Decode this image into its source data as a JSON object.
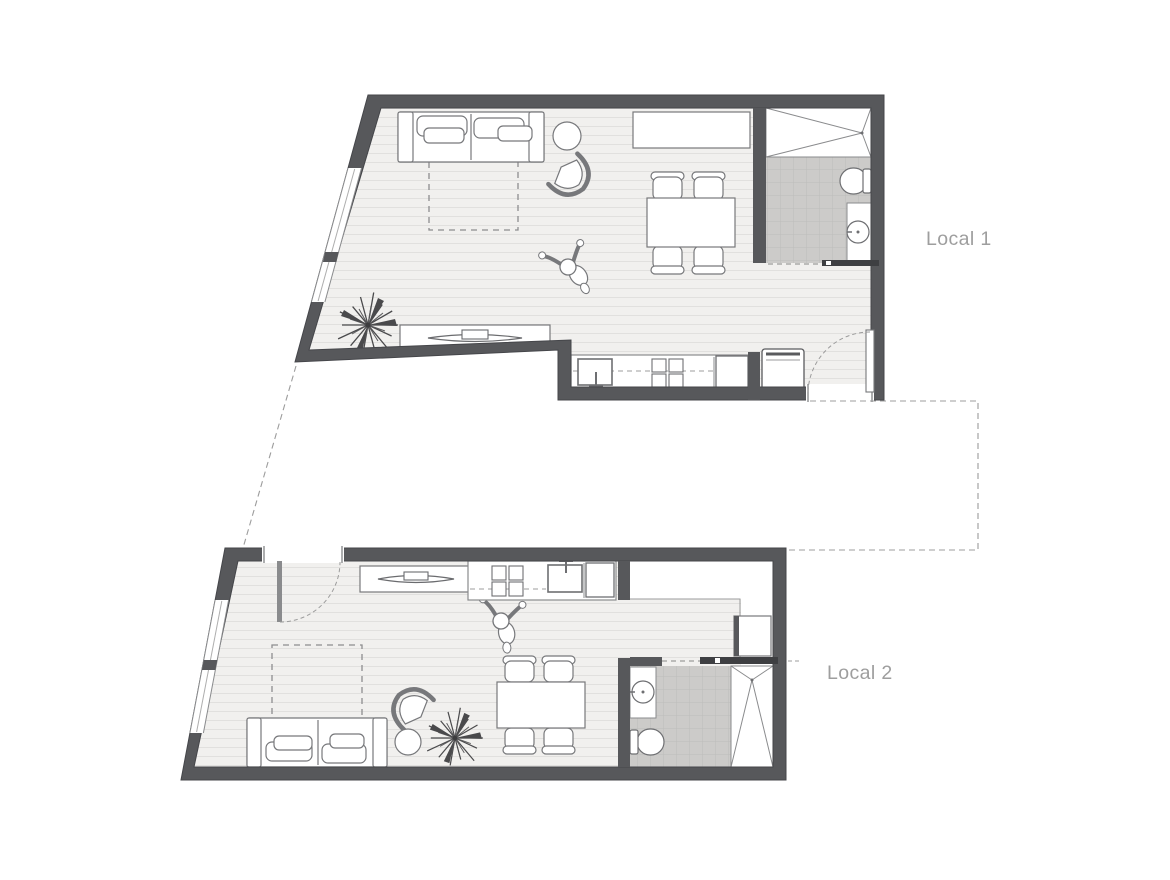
{
  "page": {
    "background_color": "#ffffff",
    "type": "architectural floor plan, two studio units"
  },
  "units": [
    {
      "id": "local-1",
      "label": "Local 1",
      "rooms": [
        "living-dining",
        "kitchen",
        "bathroom",
        "entry"
      ],
      "furniture_icons": [
        "sofa-icon",
        "side-table-icon",
        "lounge-chair-icon",
        "rug-icon",
        "dining-table-icon",
        "dining-chair-icon",
        "sideboard-icon",
        "tv-console-icon",
        "plant-icon",
        "kitchen-counter-icon",
        "kitchen-sink-icon",
        "cooktop-icon",
        "appliance-icon",
        "fridge-icon",
        "shower-icon",
        "toilet-icon",
        "washbasin-icon",
        "person-icon",
        "entry-door-icon",
        "sliding-door-icon",
        "window-icon"
      ]
    },
    {
      "id": "local-2",
      "label": "Local 2",
      "rooms": [
        "living-dining",
        "kitchen",
        "bathroom",
        "entry"
      ],
      "furniture_icons": [
        "sofa-icon",
        "side-table-icon",
        "lounge-chair-icon",
        "rug-icon",
        "dining-table-icon",
        "dining-chair-icon",
        "tv-console-icon",
        "plant-icon",
        "kitchen-counter-icon",
        "kitchen-sink-icon",
        "cooktop-icon",
        "appliance-icon",
        "fridge-icon",
        "shower-icon",
        "toilet-icon",
        "washbasin-icon",
        "person-icon",
        "entry-door-icon",
        "sliding-door-icon",
        "window-icon"
      ]
    }
  ],
  "colors": {
    "wall": "#57585b",
    "wall_edge": "#45464a",
    "floor": "#f1f0ee",
    "floor_stripe": "#e1e0de",
    "tile": "#cccbc9",
    "tile_grid": "#bdbcba",
    "furniture_outline": "#77787b",
    "dashed_guide": "#9c9c9c",
    "label_text": "#9e9e9e",
    "white": "#ffffff"
  }
}
